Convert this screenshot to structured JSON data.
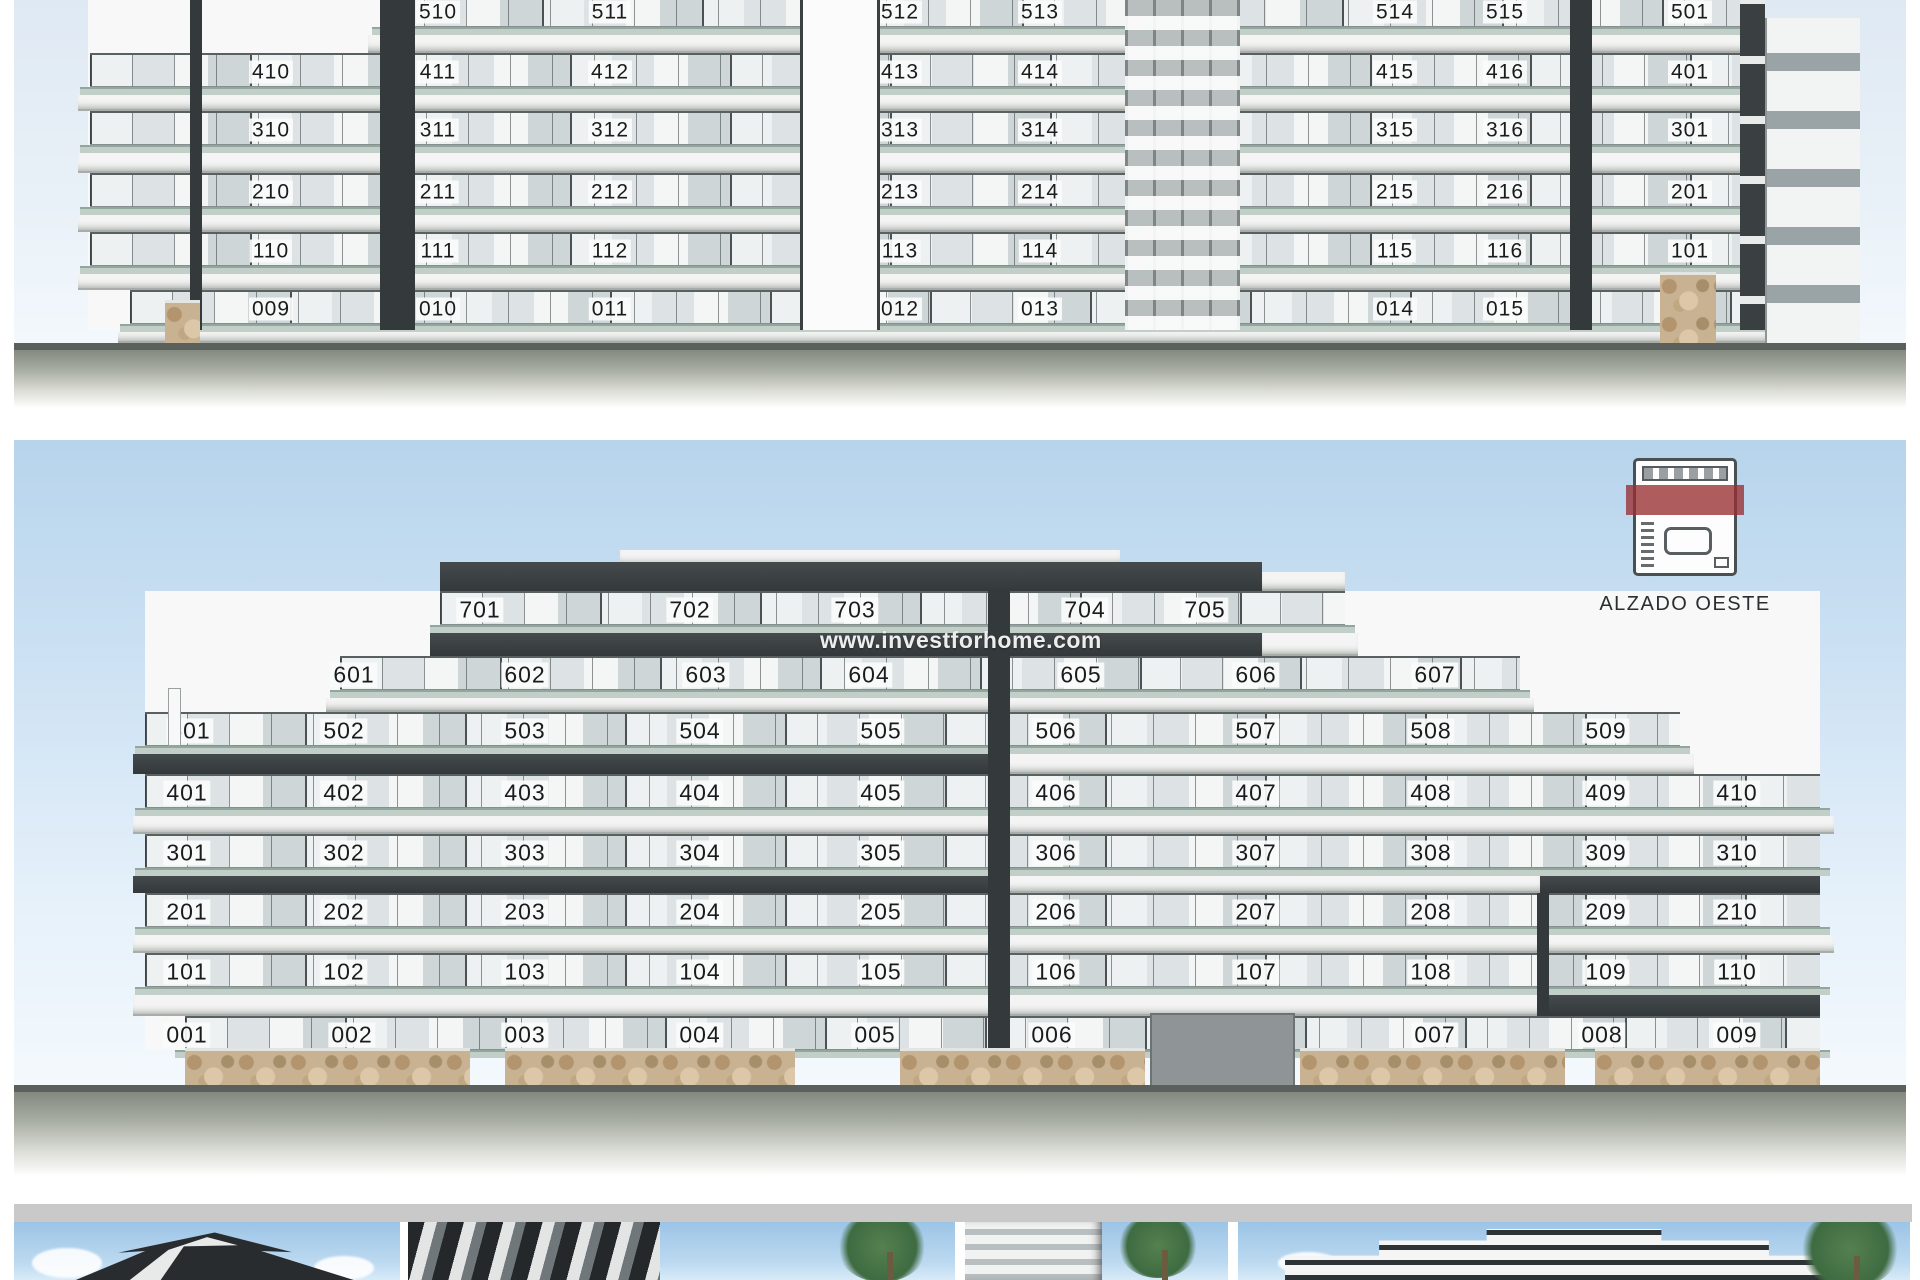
{
  "watermark": {
    "text": "www.investforhome.com"
  },
  "legend": {
    "label": "ALZADO OESTE",
    "icon": "west-facade-plan-icon",
    "accent_color": "#982e32"
  },
  "colors": {
    "fascia_dark": "#33383a",
    "slab_light": "#f3f4f3",
    "rail": "#c2cfc8",
    "stone": "#c9b292",
    "sky": "#b7d4ec"
  },
  "panel1": {
    "name": "upper-elevation-cropped",
    "floors": [
      {
        "y": 12,
        "strip": [
          382,
          1765
        ],
        "bb": 53,
        "bands": [
          {
            "x1": 368,
            "x2": 1779,
            "dark": false
          }
        ],
        "units": [
          {
            "t": "510",
            "x": 438
          },
          {
            "t": "511",
            "x": 610
          },
          {
            "t": "512",
            "x": 900
          },
          {
            "t": "513",
            "x": 1040
          },
          {
            "t": "514",
            "x": 1395
          },
          {
            "t": "515",
            "x": 1505
          },
          {
            "t": "501",
            "x": 1690
          }
        ]
      },
      {
        "y": 72,
        "strip": [
          90,
          1765
        ],
        "bb": 111,
        "bands": [
          {
            "x1": 78,
            "x2": 1779,
            "dark": false
          }
        ],
        "units": [
          {
            "t": "410",
            "x": 271
          },
          {
            "t": "411",
            "x": 438
          },
          {
            "t": "412",
            "x": 610
          },
          {
            "t": "413",
            "x": 900
          },
          {
            "t": "414",
            "x": 1040
          },
          {
            "t": "415",
            "x": 1395
          },
          {
            "t": "416",
            "x": 1505
          },
          {
            "t": "401",
            "x": 1690
          }
        ]
      },
      {
        "y": 130,
        "strip": [
          90,
          1765
        ],
        "bb": 173,
        "bands": [
          {
            "x1": 78,
            "x2": 1779,
            "dark": false
          }
        ],
        "units": [
          {
            "t": "310",
            "x": 271
          },
          {
            "t": "311",
            "x": 438
          },
          {
            "t": "312",
            "x": 610
          },
          {
            "t": "313",
            "x": 900
          },
          {
            "t": "314",
            "x": 1040
          },
          {
            "t": "315",
            "x": 1395
          },
          {
            "t": "316",
            "x": 1505
          },
          {
            "t": "301",
            "x": 1690
          }
        ]
      },
      {
        "y": 192,
        "strip": [
          90,
          1765
        ],
        "bb": 232,
        "bands": [
          {
            "x1": 78,
            "x2": 1779,
            "dark": false
          }
        ],
        "units": [
          {
            "t": "210",
            "x": 271
          },
          {
            "t": "211",
            "x": 438
          },
          {
            "t": "212",
            "x": 610
          },
          {
            "t": "213",
            "x": 900
          },
          {
            "t": "214",
            "x": 1040
          },
          {
            "t": "215",
            "x": 1395
          },
          {
            "t": "216",
            "x": 1505
          },
          {
            "t": "201",
            "x": 1690
          }
        ]
      },
      {
        "y": 251,
        "strip": [
          90,
          1765
        ],
        "bb": 290,
        "bands": [
          {
            "x1": 78,
            "x2": 1779,
            "dark": false
          }
        ],
        "units": [
          {
            "t": "110",
            "x": 271
          },
          {
            "t": "111",
            "x": 438
          },
          {
            "t": "112",
            "x": 610
          },
          {
            "t": "113",
            "x": 900
          },
          {
            "t": "114",
            "x": 1040
          },
          {
            "t": "115",
            "x": 1395
          },
          {
            "t": "116",
            "x": 1505
          },
          {
            "t": "101",
            "x": 1690
          }
        ]
      },
      {
        "y": 309,
        "strip": [
          130,
          1765
        ],
        "bb": 343,
        "bands": [
          {
            "x1": 118,
            "x2": 1765,
            "dark": false
          }
        ],
        "units": [
          {
            "t": "009",
            "x": 271
          },
          {
            "t": "010",
            "x": 438
          },
          {
            "t": "011",
            "x": 610
          },
          {
            "t": "012",
            "x": 900
          },
          {
            "t": "013",
            "x": 1040
          },
          {
            "t": "014",
            "x": 1395
          },
          {
            "t": "015",
            "x": 1505
          },
          {
            "t": "001",
            "x": 1690
          }
        ]
      }
    ]
  },
  "panel2": {
    "name": "alzado-oeste-elevation",
    "floors": [
      {
        "y": 610,
        "strip": [
          440,
          1345
        ],
        "bb": 656,
        "bands": [
          {
            "x1": 430,
            "x2": 1262,
            "dark": true
          },
          {
            "x1": 1262,
            "x2": 1358,
            "dark": false
          }
        ],
        "units": [
          {
            "t": "701",
            "x": 480
          },
          {
            "t": "702",
            "x": 690
          },
          {
            "t": "703",
            "x": 855
          },
          {
            "t": "704",
            "x": 1085
          },
          {
            "t": "705",
            "x": 1205
          }
        ]
      },
      {
        "y": 675,
        "strip": [
          340,
          1520
        ],
        "bb": 712,
        "bands": [
          {
            "x1": 326,
            "x2": 1534,
            "dark": false
          }
        ],
        "units": [
          {
            "t": "601",
            "x": 354
          },
          {
            "t": "602",
            "x": 525
          },
          {
            "t": "603",
            "x": 706
          },
          {
            "t": "604",
            "x": 869
          },
          {
            "t": "605",
            "x": 1081
          },
          {
            "t": "606",
            "x": 1256
          },
          {
            "t": "607",
            "x": 1435
          }
        ]
      },
      {
        "y": 731,
        "strip": [
          145,
          1680
        ],
        "bb": 774,
        "bands": [
          {
            "x1": 133,
            "x2": 1000,
            "dark": true
          },
          {
            "x1": 1000,
            "x2": 1694,
            "dark": false
          }
        ],
        "units": [
          {
            "t": "501",
            "x": 190
          },
          {
            "t": "502",
            "x": 344
          },
          {
            "t": "503",
            "x": 525
          },
          {
            "t": "504",
            "x": 700
          },
          {
            "t": "505",
            "x": 881
          },
          {
            "t": "506",
            "x": 1056
          },
          {
            "t": "507",
            "x": 1256
          },
          {
            "t": "508",
            "x": 1431
          },
          {
            "t": "509",
            "x": 1606
          }
        ]
      },
      {
        "y": 793,
        "strip": [
          145,
          1820
        ],
        "bb": 834,
        "bands": [
          {
            "x1": 133,
            "x2": 1834,
            "dark": false
          }
        ],
        "units": [
          {
            "t": "401",
            "x": 187
          },
          {
            "t": "402",
            "x": 344
          },
          {
            "t": "403",
            "x": 525
          },
          {
            "t": "404",
            "x": 700
          },
          {
            "t": "405",
            "x": 881
          },
          {
            "t": "406",
            "x": 1056
          },
          {
            "t": "407",
            "x": 1256
          },
          {
            "t": "408",
            "x": 1431
          },
          {
            "t": "409",
            "x": 1606
          },
          {
            "t": "410",
            "x": 1737
          }
        ]
      },
      {
        "y": 853,
        "strip": [
          145,
          1820
        ],
        "bb": 893,
        "bands": [
          {
            "x1": 133,
            "x2": 1000,
            "dark": true
          },
          {
            "x1": 1000,
            "x2": 1540,
            "dark": false
          },
          {
            "x1": 1540,
            "x2": 1820,
            "dark": true
          }
        ],
        "units": [
          {
            "t": "301",
            "x": 187
          },
          {
            "t": "302",
            "x": 344
          },
          {
            "t": "303",
            "x": 525
          },
          {
            "t": "304",
            "x": 700
          },
          {
            "t": "305",
            "x": 881
          },
          {
            "t": "306",
            "x": 1056
          },
          {
            "t": "307",
            "x": 1256
          },
          {
            "t": "308",
            "x": 1431
          },
          {
            "t": "309",
            "x": 1606
          },
          {
            "t": "310",
            "x": 1737
          }
        ]
      },
      {
        "y": 912,
        "strip": [
          145,
          1820
        ],
        "bb": 953,
        "bands": [
          {
            "x1": 133,
            "x2": 1540,
            "dark": false
          },
          {
            "x1": 1540,
            "x2": 1834,
            "dark": false
          }
        ],
        "units": [
          {
            "t": "201",
            "x": 187
          },
          {
            "t": "202",
            "x": 344
          },
          {
            "t": "203",
            "x": 525
          },
          {
            "t": "204",
            "x": 700
          },
          {
            "t": "205",
            "x": 881
          },
          {
            "t": "206",
            "x": 1056
          },
          {
            "t": "207",
            "x": 1256
          },
          {
            "t": "208",
            "x": 1431
          },
          {
            "t": "209",
            "x": 1606
          },
          {
            "t": "210",
            "x": 1737
          }
        ]
      },
      {
        "y": 972,
        "strip": [
          145,
          1820
        ],
        "bb": 1016,
        "bands": [
          {
            "x1": 133,
            "x2": 1540,
            "dark": false
          },
          {
            "x1": 1540,
            "x2": 1820,
            "dark": true
          }
        ],
        "units": [
          {
            "t": "101",
            "x": 187
          },
          {
            "t": "102",
            "x": 344
          },
          {
            "t": "103",
            "x": 525
          },
          {
            "t": "104",
            "x": 700
          },
          {
            "t": "105",
            "x": 881
          },
          {
            "t": "106",
            "x": 1056
          },
          {
            "t": "107",
            "x": 1256
          },
          {
            "t": "108",
            "x": 1431
          },
          {
            "t": "109",
            "x": 1606
          },
          {
            "t": "110",
            "x": 1737
          }
        ]
      },
      {
        "y": 1035,
        "strip": [
          185,
          1820
        ],
        "bb": 1050,
        "bands": [],
        "units": [
          {
            "t": "001",
            "x": 187
          },
          {
            "t": "002",
            "x": 352
          },
          {
            "t": "003",
            "x": 525
          },
          {
            "t": "004",
            "x": 700
          },
          {
            "t": "005",
            "x": 875
          },
          {
            "t": "006",
            "x": 1052
          },
          {
            "t": "007",
            "x": 1435
          },
          {
            "t": "008",
            "x": 1602
          },
          {
            "t": "009",
            "x": 1737
          }
        ]
      }
    ]
  },
  "thumbnails": [
    {
      "name": "render-dark-angular-building"
    },
    {
      "name": "render-balcony-closeup-with-palm"
    },
    {
      "name": "render-facade-with-palms"
    },
    {
      "name": "render-stepped-building-wide"
    }
  ]
}
